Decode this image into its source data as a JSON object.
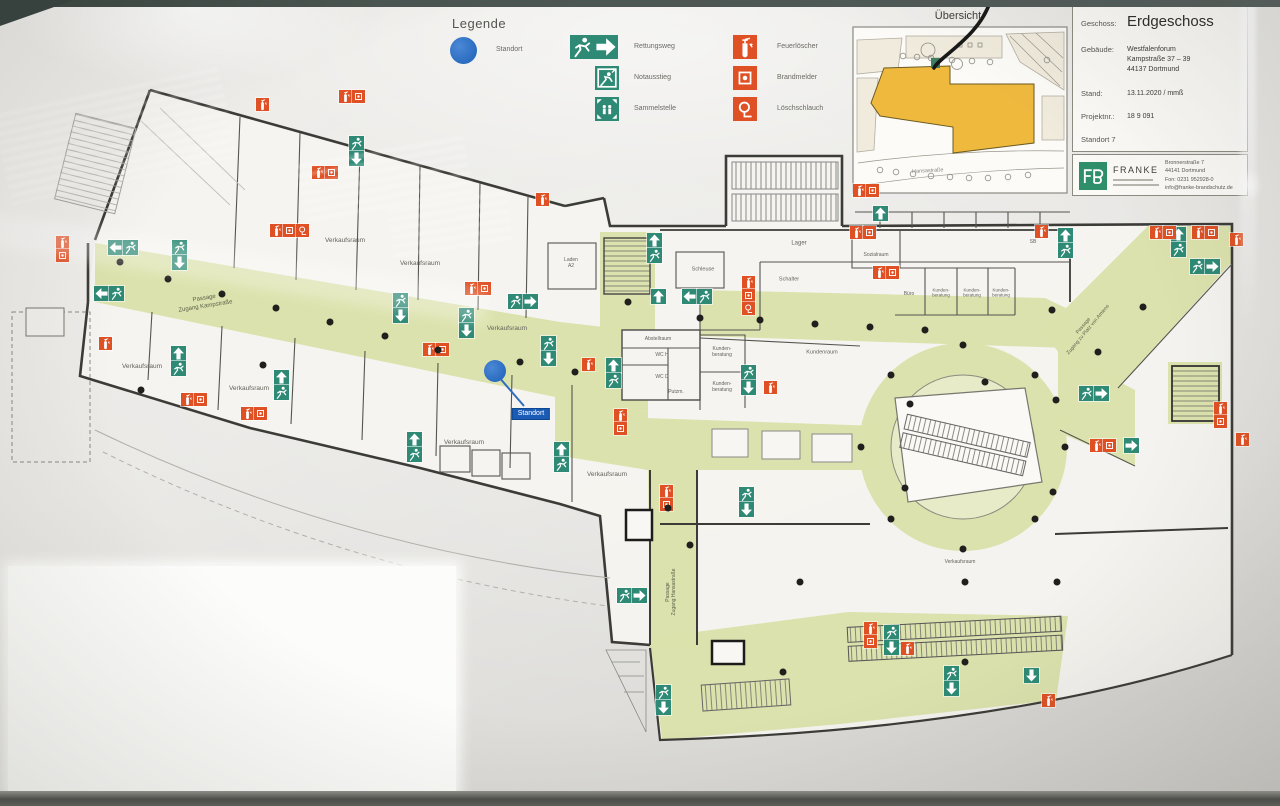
{
  "colors": {
    "sign_green": "#2e8a75",
    "sign_red": "#df5125",
    "route_green": "#dce2ab",
    "standort_blue": "#2a6cc0",
    "overview_building_yellow": "#efb93e",
    "franke_green": "#2f8f6a",
    "wall": "#3b3b37"
  },
  "legend": {
    "title": "Legende",
    "standort_label": "Standort",
    "green_items": [
      {
        "icon": "rescue-route",
        "label": "Rettungsweg"
      },
      {
        "icon": "emergency-exit-window",
        "label": "Notausstieg"
      },
      {
        "icon": "assembly-point",
        "label": "Sammelstelle"
      }
    ],
    "red_items": [
      {
        "icon": "fire-extinguisher",
        "label": "Feuerlöscher"
      },
      {
        "icon": "fire-alarm",
        "label": "Brandmelder"
      },
      {
        "icon": "fire-hose",
        "label": "Löschschlauch"
      }
    ]
  },
  "overview": {
    "title": "Übersicht",
    "street_label": "Hansastraße"
  },
  "info_panel": {
    "geschoss_label": "Geschoss:",
    "geschoss_value": "Erdgeschoss",
    "gebaeude_label": "Gebäude:",
    "gebaeude_lines": [
      "Westfalenforum",
      "Kampstraße 37 – 39",
      "44137 Dortmund"
    ],
    "stand_label": "Stand:",
    "stand_value": "13.11.2020 / mmß",
    "projekt_label": "Projektnr.:",
    "projekt_value": "18 9 091",
    "standort_line": "Standort 7",
    "franke": {
      "name": "FRANKE",
      "address": [
        "Bronnerstraße 7",
        "44141 Dortmund",
        "Fon: 0231 952928-0",
        "info@franke-brandschutz.de"
      ]
    }
  },
  "plan": {
    "standort_label": "Standort",
    "rooms": [
      {
        "t": "Verkaufsraum",
        "x": 345,
        "y": 241
      },
      {
        "t": "Verkaufsraum",
        "x": 420,
        "y": 264
      },
      {
        "t": "Verkaufsraum",
        "x": 507,
        "y": 329
      },
      {
        "t": "Verkaufsraum",
        "x": 142,
        "y": 367
      },
      {
        "t": "Verkaufsraum",
        "x": 249,
        "y": 389
      },
      {
        "t": "Verkaufsraum",
        "x": 464,
        "y": 443
      },
      {
        "t": "Verkaufsraum",
        "x": 607,
        "y": 475
      },
      {
        "t": "Verkaufsraum",
        "x": 960,
        "y": 562,
        "s": 5
      },
      {
        "t": "Schleuse",
        "x": 703,
        "y": 270,
        "s": 5.5
      },
      {
        "t": "Lager",
        "x": 799,
        "y": 244,
        "s": 6
      },
      {
        "t": "Schalter",
        "x": 789,
        "y": 280,
        "s": 5.5
      },
      {
        "t": "Abstellraum",
        "x": 658,
        "y": 339,
        "s": 5
      },
      {
        "t": "WC H",
        "x": 662,
        "y": 355,
        "s": 5
      },
      {
        "t": "WC D",
        "x": 662,
        "y": 377,
        "s": 5
      },
      {
        "t": "Putzm.",
        "x": 676,
        "y": 392,
        "s": 5
      },
      {
        "t": "Kunden-\nberatung",
        "x": 722,
        "y": 352,
        "s": 5
      },
      {
        "t": "Kunden-\nberatung",
        "x": 722,
        "y": 387,
        "s": 5
      },
      {
        "t": "Kundenraum",
        "x": 822,
        "y": 353,
        "s": 5.5
      },
      {
        "t": "Sozialraum",
        "x": 876,
        "y": 255,
        "s": 5
      },
      {
        "t": "Büro",
        "x": 909,
        "y": 294,
        "s": 5
      },
      {
        "t": "Kunden-\nberatung",
        "x": 941,
        "y": 293,
        "s": 4.5
      },
      {
        "t": "Kunden-\nberatung",
        "x": 972,
        "y": 293,
        "s": 4.5
      },
      {
        "t": "Kunden-\nberatung",
        "x": 1001,
        "y": 293,
        "s": 4.5
      },
      {
        "t": "Laden\nA2",
        "x": 571,
        "y": 263,
        "s": 5
      },
      {
        "t": "SB",
        "x": 1033,
        "y": 242,
        "s": 5
      }
    ],
    "passages": [
      {
        "t": "Passage\nZugang Kampstraße",
        "x": 205,
        "y": 303,
        "r": -9,
        "s": 6
      },
      {
        "t": "Passage\nZugang zu Platz von Amiens",
        "x": 1086,
        "y": 328,
        "r": -50,
        "s": 5
      },
      {
        "t": "Passage\nZugang Hansastraße",
        "x": 671,
        "y": 592,
        "r": -90,
        "s": 5
      }
    ],
    "standort_marker": {
      "dot_x": 495,
      "dot_y": 371,
      "box_x": 531,
      "box_y": 414
    },
    "signs": [
      [
        "g2h-left",
        94,
        286
      ],
      [
        "g2h-left",
        108,
        240
      ],
      [
        "g2v-down",
        172,
        240
      ],
      [
        "g2v-down",
        349,
        136
      ],
      [
        "g2v-up",
        171,
        346
      ],
      [
        "g2v-up",
        274,
        370
      ],
      [
        "g2v-down",
        393,
        293
      ],
      [
        "g2v-down",
        459,
        308
      ],
      [
        "g2h-right",
        508,
        294
      ],
      [
        "g2v-up",
        407,
        432
      ],
      [
        "g2v-up",
        554,
        442
      ],
      [
        "g2v-down",
        541,
        336
      ],
      [
        "g2v-up",
        606,
        358
      ],
      [
        "g2v-up",
        647,
        233
      ],
      [
        "g-up",
        651,
        289
      ],
      [
        "g2h-left",
        682,
        289
      ],
      [
        "g2v-down",
        741,
        365
      ],
      [
        "g2v-down",
        739,
        487
      ],
      [
        "g2h-right",
        617,
        588
      ],
      [
        "g2v-down",
        656,
        685
      ],
      [
        "g2v-down",
        884,
        625
      ],
      [
        "g2v-down",
        944,
        666
      ],
      [
        "g-down",
        1024,
        668
      ],
      [
        "g2v-up",
        1058,
        228
      ],
      [
        "g2v-up",
        1171,
        227
      ],
      [
        "g2h-right",
        1190,
        259
      ],
      [
        "g2h-right",
        1079,
        386
      ],
      [
        "g-right",
        1124,
        438
      ],
      [
        "g-up",
        873,
        206
      ],
      [
        "r2v",
        56,
        236
      ],
      [
        "rs",
        99,
        337
      ],
      [
        "r2h",
        181,
        393
      ],
      [
        "r2h",
        241,
        407
      ],
      [
        "r3h",
        270,
        224
      ],
      [
        "r2h",
        423,
        343
      ],
      [
        "r2h",
        465,
        282
      ],
      [
        "r2v",
        614,
        409
      ],
      [
        "r2v",
        660,
        485
      ],
      [
        "r3v",
        742,
        276
      ],
      [
        "rs",
        764,
        381
      ],
      [
        "r2h",
        850,
        226
      ],
      [
        "r2h",
        873,
        266
      ],
      [
        "rs",
        1035,
        225
      ],
      [
        "r2h",
        1150,
        226
      ],
      [
        "r2h",
        1192,
        226
      ],
      [
        "rs",
        1230,
        233
      ],
      [
        "r2v",
        1214,
        402
      ],
      [
        "rs",
        1236,
        433
      ],
      [
        "r2h",
        1090,
        439
      ],
      [
        "r2v",
        864,
        622
      ],
      [
        "rs",
        901,
        642
      ],
      [
        "rs",
        1042,
        694
      ],
      [
        "rs",
        256,
        98
      ],
      [
        "r2h",
        312,
        166
      ],
      [
        "r2h",
        339,
        90
      ],
      [
        "rs",
        536,
        193
      ],
      [
        "r2h",
        853,
        184
      ],
      [
        "rs",
        582,
        358
      ]
    ],
    "columns": [
      [
        120,
        262
      ],
      [
        168,
        279
      ],
      [
        222,
        294
      ],
      [
        276,
        308
      ],
      [
        330,
        322
      ],
      [
        385,
        336
      ],
      [
        438,
        350
      ],
      [
        520,
        362
      ],
      [
        575,
        372
      ],
      [
        628,
        302
      ],
      [
        700,
        318
      ],
      [
        760,
        320
      ],
      [
        815,
        324
      ],
      [
        870,
        327
      ],
      [
        925,
        330
      ],
      [
        1052,
        310
      ],
      [
        1143,
        307
      ],
      [
        1098,
        352
      ],
      [
        963,
        345
      ],
      [
        1035,
        375
      ],
      [
        1065,
        447
      ],
      [
        1035,
        519
      ],
      [
        963,
        549
      ],
      [
        891,
        519
      ],
      [
        861,
        447
      ],
      [
        891,
        375
      ],
      [
        985,
        382
      ],
      [
        910,
        404
      ],
      [
        1056,
        400
      ],
      [
        905,
        488
      ],
      [
        1053,
        492
      ],
      [
        800,
        582
      ],
      [
        965,
        582
      ],
      [
        1057,
        582
      ],
      [
        783,
        672
      ],
      [
        965,
        662
      ],
      [
        141,
        390
      ],
      [
        263,
        365
      ],
      [
        690,
        545
      ],
      [
        668,
        508
      ]
    ]
  }
}
